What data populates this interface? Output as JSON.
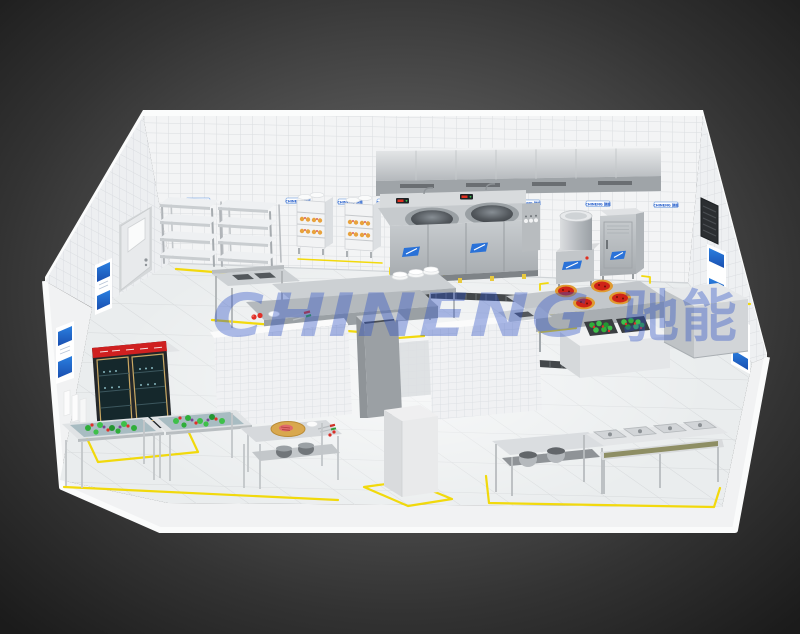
{
  "scene": {
    "watermark": {
      "latin": "CHINENG",
      "cn": "驰能"
    },
    "wall_label_text": "CHINENG 驰能",
    "colors": {
      "background_center": "#6b6b6b",
      "background_edge": "#1b1b1b",
      "watermark_blue": "#2a4fc4",
      "floor_marking_yellow": "#f2d800",
      "poster_blue": "#1f6fd6",
      "burner_red": "#cf2318",
      "veg_green": "#2fae3a",
      "fridge_band_red": "#cf2020",
      "stainless": "#cdd1d4",
      "tile_white": "#f3f4f5"
    }
  }
}
